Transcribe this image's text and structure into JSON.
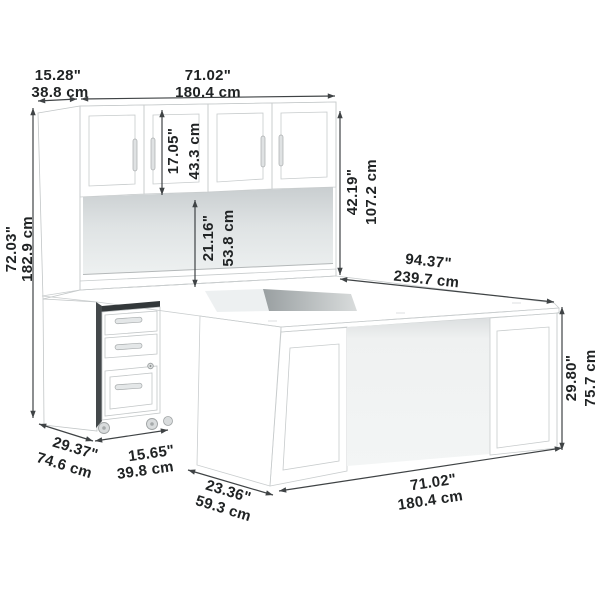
{
  "title": "U Shaped Desk with Hutch and Mobile File Cabinet — Dimension Diagram",
  "colors": {
    "background": "#ffffff",
    "furniture_face": "#f8fafa",
    "furniture_side": "#edefef",
    "dimension_line": "#3f4345",
    "label_text": "#202324",
    "led_strip": "#ffffff",
    "opening_shadow": "#9aa0a2"
  },
  "dims": {
    "hutch_depth": {
      "inches": "15.28\"",
      "cm": "38.8 cm"
    },
    "hutch_width": {
      "inches": "71.02\"",
      "cm": "180.4 cm"
    },
    "hutch_door_height": {
      "inches": "17.05\"",
      "cm": "43.3 cm"
    },
    "hutch_open_height": {
      "inches": "21.16\"",
      "cm": "53.8 cm"
    },
    "hutch_height": {
      "inches": "42.19\"",
      "cm": "107.2 cm"
    },
    "overall_height": {
      "inches": "72.03\"",
      "cm": "182.9 cm"
    },
    "overall_depth": {
      "inches": "94.37\"",
      "cm": "239.7 cm"
    },
    "desk_height": {
      "inches": "29.80\"",
      "cm": "75.7 cm"
    },
    "return_depth": {
      "inches": "29.37\"",
      "cm": "74.6 cm"
    },
    "file_cabinet_width": {
      "inches": "15.65\"",
      "cm": "39.8 cm"
    },
    "desk_depth": {
      "inches": "23.36\"",
      "cm": "59.3 cm"
    },
    "desk_width": {
      "inches": "71.02\"",
      "cm": "180.4 cm"
    }
  }
}
